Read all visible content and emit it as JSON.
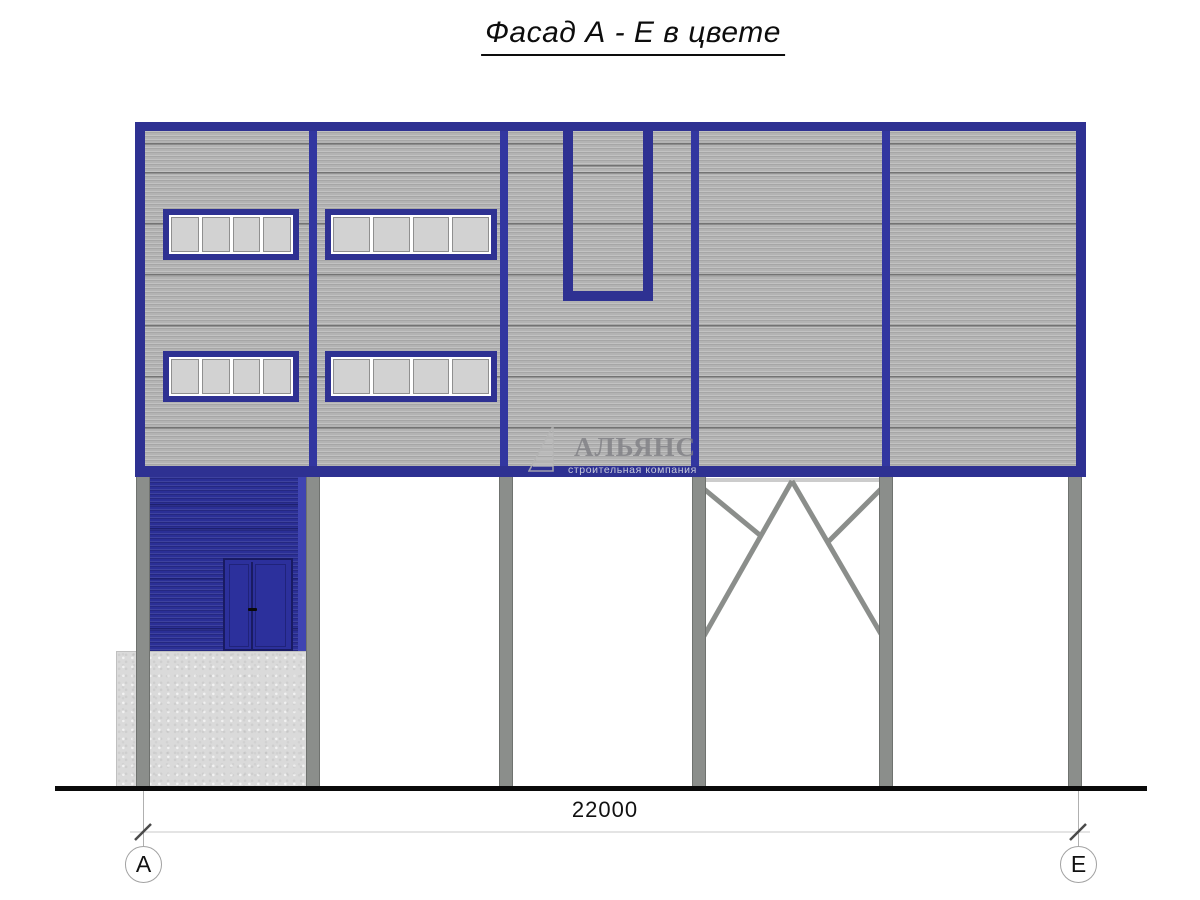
{
  "title": {
    "text": "Фасад А - Е в цвете"
  },
  "watermark": {
    "company": "АЛЬЯНС",
    "tagline": "строительная компания",
    "logo": "sail-logo"
  },
  "dimension": {
    "total_width": "22000"
  },
  "axis_markers": {
    "left": "А",
    "right": "Е"
  },
  "facade": {
    "bays": 5,
    "columns": 6,
    "window_rows": 2,
    "windows_per_row": 2,
    "panes_per_window": 4
  },
  "colors": {
    "frame_blue": "#2e3192",
    "divider_blue": "#3236a0",
    "annex_blue": "#2b2f96",
    "annex_edge_blue": "#3f44b2",
    "door_blue": "#2c309c",
    "panel_gray": "#b3b3b3",
    "glass_gray": "#d2d2d2",
    "column_gray": "#8b8e8b",
    "concrete_gray": "#dadada",
    "ground_black": "#0a0a0a",
    "dimension_line_gray": "#e4e4e4"
  }
}
